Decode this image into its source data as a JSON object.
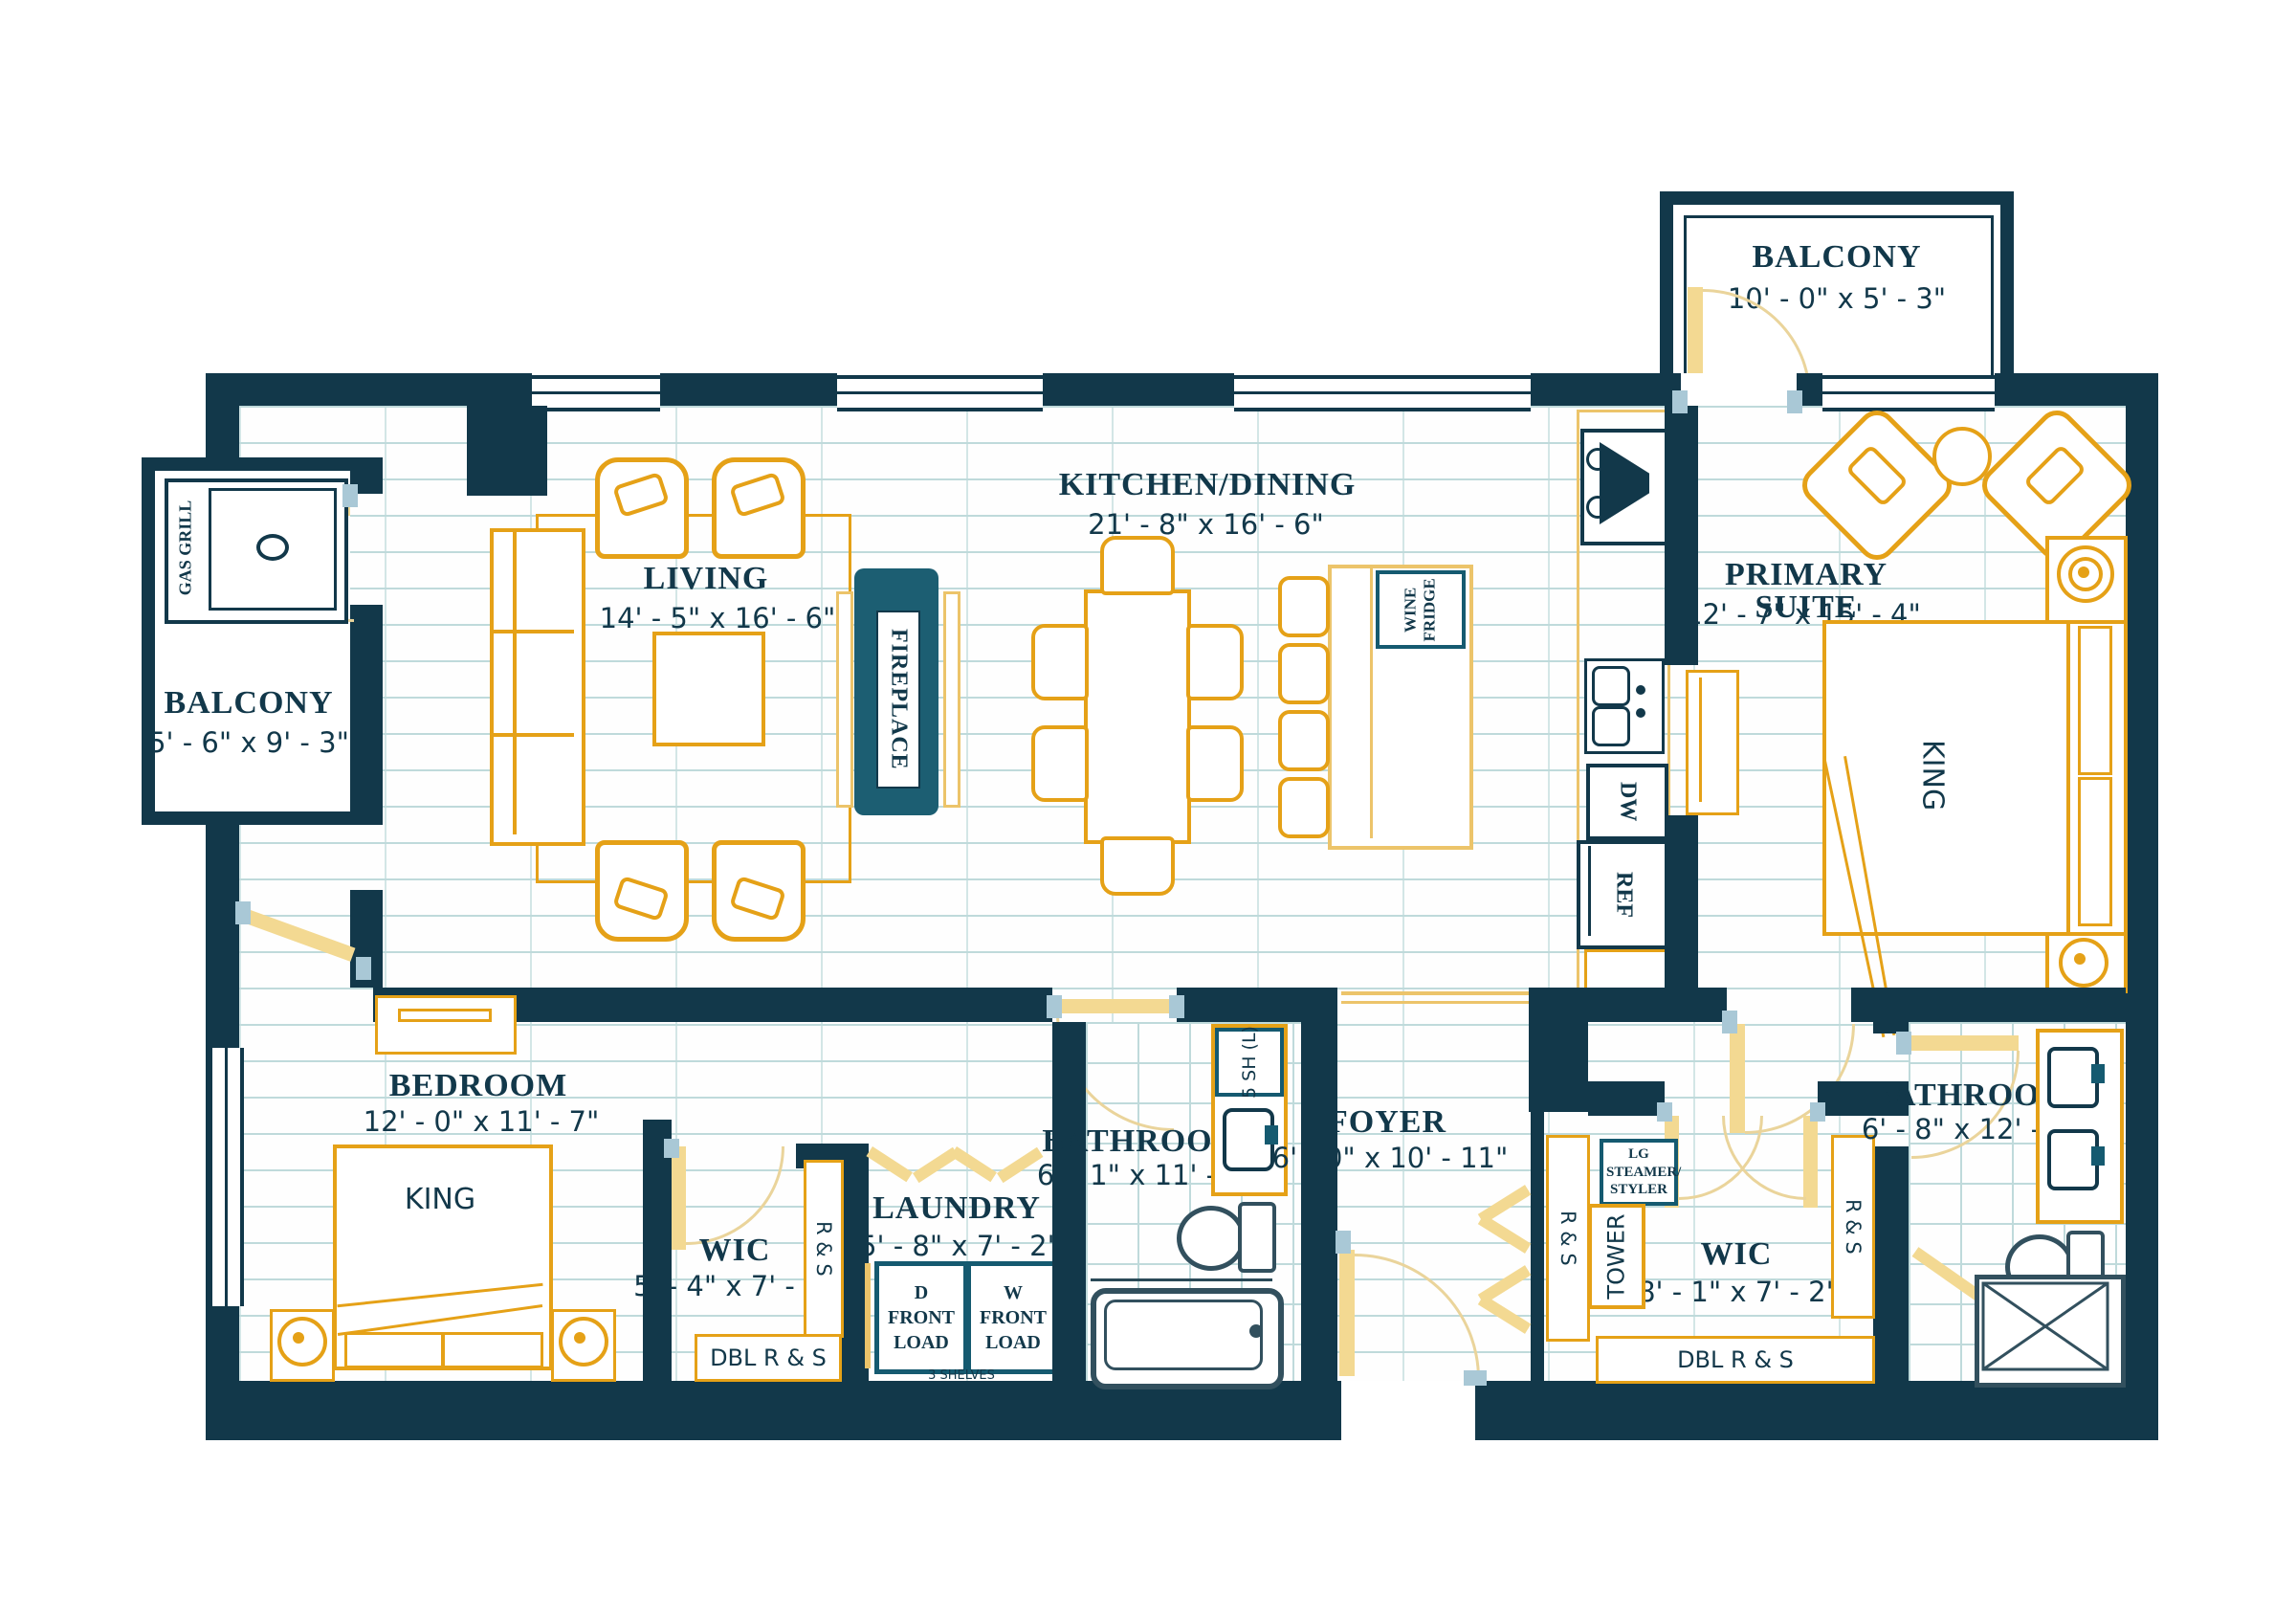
{
  "rooms": {
    "balcony_top": {
      "name": "BALCONY",
      "dims": "10' - 0\" x 5' - 3\""
    },
    "balcony_left": {
      "name": "BALCONY",
      "dims": "5' - 6\" x 9' - 3\""
    },
    "living": {
      "name": "LIVING",
      "dims": "14' - 5\" x 16' - 6\""
    },
    "kitchen": {
      "name": "KITCHEN/DINING",
      "dims": "21' - 8\" x 16' - 6\""
    },
    "primary": {
      "name": "PRIMARY SUITE",
      "dims": "12' - 7\" x 15' - 4\""
    },
    "bedroom": {
      "name": "BEDROOM",
      "dims": "12' - 0\" x 11' - 7\""
    },
    "wic_left": {
      "name": "WIC",
      "dims": "5' - 4\" x 7' - 2\""
    },
    "laundry": {
      "name": "LAUNDRY",
      "dims": "5' - 8\" x 7' - 2\""
    },
    "bath_center": {
      "name": "BATHROOM",
      "dims": "6' - 1\" x 11' - 7\""
    },
    "foyer": {
      "name": "FOYER",
      "dims": "6' - 0\" x 10' - 11\""
    },
    "wic_right": {
      "name": "WIC",
      "dims": "8' - 1\" x 7' - 2\""
    },
    "bath_right": {
      "name": "BATHROOM",
      "dims": "6' - 8\" x 12' - 9\""
    }
  },
  "fixtures": {
    "fireplace": "FIREPLACE",
    "wine_fridge": "WINE FRIDGE",
    "gas_grill": "GAS GRILL",
    "king": "KING",
    "dw": "DW",
    "ref": "REF",
    "rs": "R & S",
    "dbl_rs": "DBL R & S",
    "d_front": "D FRONT LOAD",
    "w_front": "W FRONT LOAD",
    "shelves": "3 SHELVES",
    "sh5": "5 SH (L)",
    "tower": "TOWER",
    "steamer": "LG STEAMER/ STYLER"
  },
  "colors": {
    "wall": "#12384a",
    "accent": "#155a70",
    "gold": "#e5a117",
    "door": "#f3d992",
    "floor_line": "#bfdadb"
  }
}
